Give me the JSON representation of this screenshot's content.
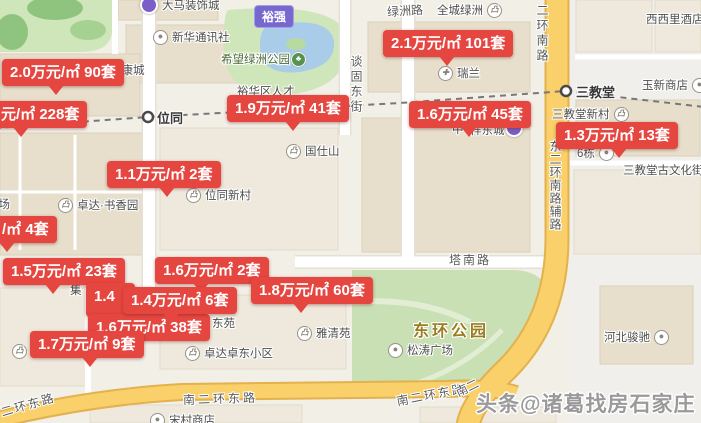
{
  "watermark": "头条@诸葛找房石家庄",
  "badge": "裕强",
  "price_labels": [
    {
      "text": "2.0万元/㎡ 90套"
    },
    {
      "text": "元/㎡ 228套"
    },
    {
      "text": "1.9万元/㎡ 41套"
    },
    {
      "text": "2.1万元/㎡ 101套"
    },
    {
      "text": "1.6万元/㎡ 45套"
    },
    {
      "text": "1.3万元/㎡ 13套"
    },
    {
      "text": "1.1万元/㎡ 2套"
    },
    {
      "text": "/㎡ 4套"
    },
    {
      "text": "1.5万元/㎡ 23套"
    },
    {
      "text": "1.6万元/㎡ 2套"
    },
    {
      "text": "1.4"
    },
    {
      "text": "1.4万元/㎡ 6套"
    },
    {
      "text": "1.8万元/㎡ 60套"
    },
    {
      "text": "1.6万元/㎡ 38套"
    },
    {
      "text": "1.7万元/㎡ 9套"
    }
  ],
  "stations": {
    "weitong": "位同",
    "sanjiaotang": "三教堂"
  },
  "roads": {
    "lvzhou": "绿洲路",
    "tangu": "谈固东街",
    "erhuan_nan": "二环南路",
    "dong_erhuan_fu": "东二环南路辅路",
    "tanan": "塔南路",
    "nan_erhuan_1": "南二环东路",
    "nan_erhuan_2": "南二环东路",
    "erhuan_dong_corner": "二环东路",
    "nan_er_frag": "南二"
  },
  "parks": {
    "xiwang": "希望绿洲公园",
    "donghuan": "东环公园"
  },
  "pois": {
    "damazhuangshi": "大马装饰城",
    "xinhua": "新华通讯社",
    "rankangcheng": "然康城",
    "yuhuaqu": "裕华区人才",
    "quancheng": "全城绿洲",
    "xixili": "西西里酒店",
    "ruilan": "瑞兰",
    "yuxin": "玉新商店",
    "sjt_xincun": "三教堂新村",
    "guwenhuajie": "三教堂古文化街",
    "liudong": "6栋",
    "guoshishan": "国仕山",
    "weitong_xincun": "位同新村",
    "shuxiangyuan": "卓达·书香园",
    "guangchang_frag": "广场",
    "zhong_frag": "中",
    "xiangdongcheng": "祥东城",
    "ji_frag": "集",
    "dongyuan_frag": "东苑",
    "yaqingyuan": "雅清苑",
    "zhuodong": "卓达卓东小区",
    "songtao": "松涛广场",
    "junchi": "河北骏驰",
    "songcun": "宋村商店"
  }
}
